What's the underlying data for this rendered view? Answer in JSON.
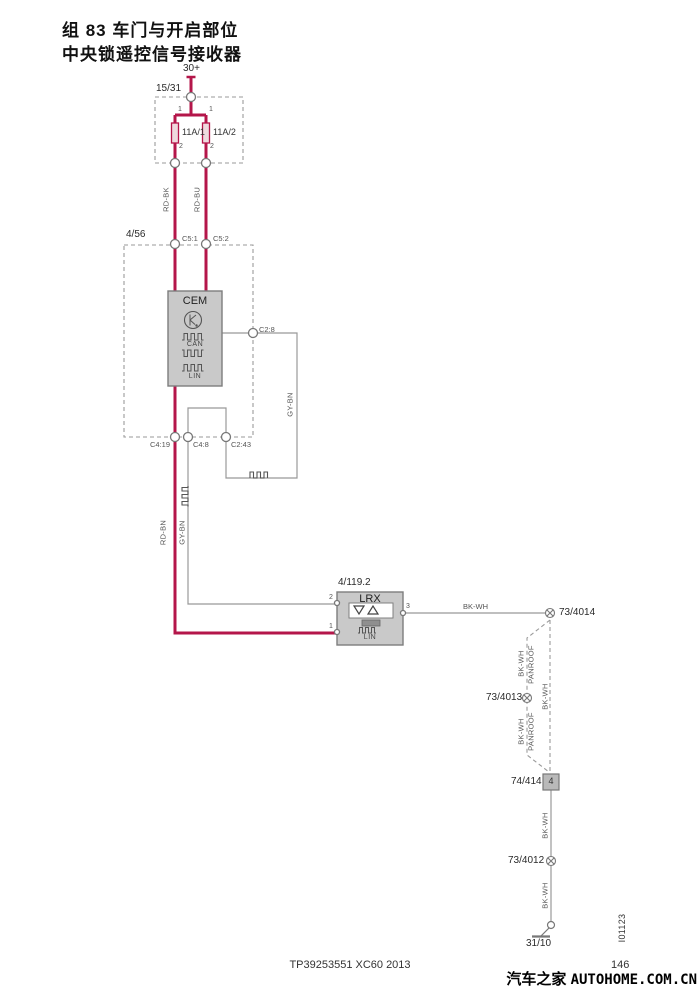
{
  "title": {
    "line1": "组 83 车门与开启部位",
    "line2": "中央锁遥控信号接收器"
  },
  "power_supply": {
    "label": "30+"
  },
  "fuse_box": {
    "id": "15/31",
    "fuse1": {
      "label": "11A/1",
      "pin_in": "1",
      "pin_out": "2"
    },
    "fuse2": {
      "label": "11A/2",
      "pin_in": "1",
      "pin_out": "2"
    }
  },
  "wire_labels": {
    "rd_bk": "RD-BK",
    "rd_bu": "RD-BU",
    "gy_bn": "GY-BN",
    "rd_bn": "RD-BN",
    "bk_wh": "BK-WH",
    "panroof": "PANROOF"
  },
  "cem_module": {
    "box_id": "4/56",
    "name": "CEM",
    "can_label": "CAN",
    "lin_label": "LIN",
    "connectors": {
      "c5_1": "C5:1",
      "c5_2": "C5:2",
      "c2_8": "C2:8",
      "c4_19": "C4:19",
      "c4_8": "C4:8",
      "c2_43": "C2:43"
    }
  },
  "lrx_module": {
    "id": "4/119.2",
    "name": "LRX",
    "lin_label": "LIN",
    "pin1": "1",
    "pin2": "2",
    "pin3": "3"
  },
  "splices": {
    "s73_4014": "73/4014",
    "s73_4013": "73/4013",
    "s73_4012": "73/4012"
  },
  "connector_74_414": {
    "id": "74/414",
    "pin": "4"
  },
  "ground": {
    "id": "31/10"
  },
  "footer": {
    "doc_code": "TP39253551 XC60 2013",
    "page_number": "146",
    "diagram_id": "I01123"
  },
  "watermark": {
    "site_cn": "汽车之家",
    "site_en": "AUTOHOME.COM.CN"
  },
  "colors": {
    "wire_power": "#b4164a",
    "wire_signal": "#999999",
    "module_fill": "#c9c9c9",
    "fuse_fill": "#eedade"
  }
}
